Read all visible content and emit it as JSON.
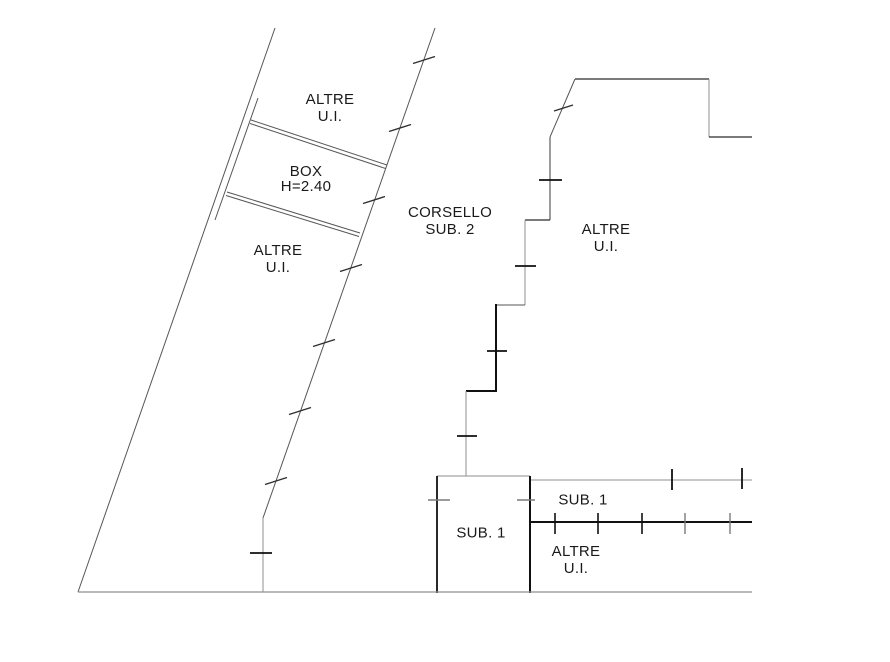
{
  "labels": {
    "altre_top": {
      "line1": "ALTRE",
      "line2": "U.I."
    },
    "box": {
      "line1": "BOX",
      "line2": "H=2.40"
    },
    "altre_left": {
      "line1": "ALTRE",
      "line2": "U.I."
    },
    "corsello": {
      "line1": "CORSELLO",
      "line2": "SUB. 2"
    },
    "altre_right": {
      "line1": "ALTRE",
      "line2": "U.I."
    },
    "sub1_strip": {
      "line1": "SUB. 1"
    },
    "sub1_box": {
      "line1": "SUB. 1"
    },
    "altre_bottom": {
      "line1": "ALTRE",
      "line2": "U.I."
    }
  },
  "colors": {
    "background": "#ffffff",
    "text": "#1a1a1a",
    "line_black": "#111111",
    "line_thin": "#565656",
    "line_gray": "#8f8f8f"
  }
}
